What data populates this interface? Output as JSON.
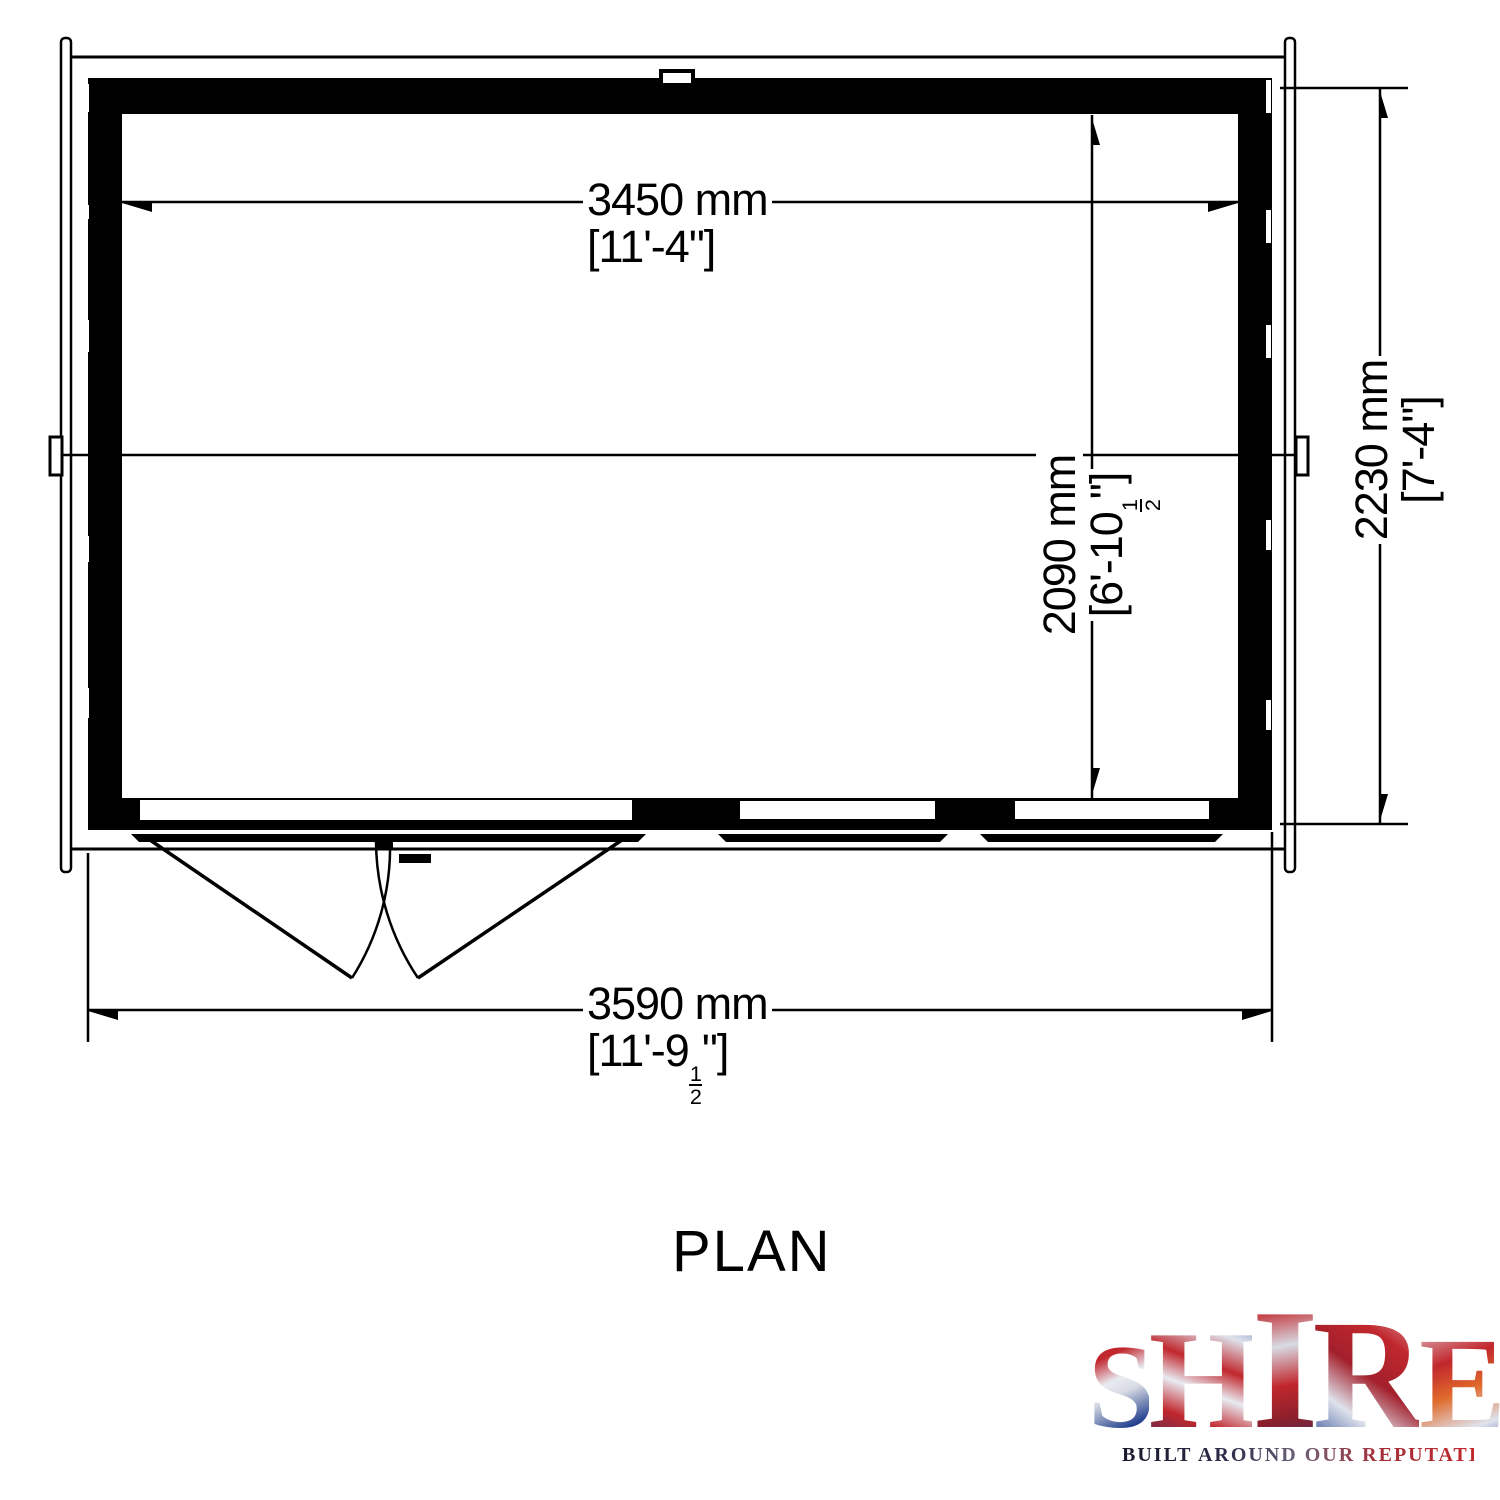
{
  "plan": {
    "title": "PLAN",
    "dimensions": {
      "inner_width": {
        "metric": "3450 mm",
        "imperial": "[11'-4\"]"
      },
      "outer_width": {
        "metric": "3590 mm",
        "imperial_pre": "[11'-9",
        "frac_num": "1",
        "frac_den": "2",
        "imperial_post": "\"]"
      },
      "inner_depth": {
        "metric": "2090 mm",
        "imperial_pre": "[6'-10",
        "frac_num": "1",
        "frac_den": "2",
        "imperial_post": "\"]"
      },
      "outer_depth": {
        "metric": "2230 mm",
        "imperial": "[7'-4\"]"
      }
    }
  },
  "logo": {
    "letters": {
      "s": "S",
      "h": "H",
      "i": "I",
      "r": "R",
      "e": "E"
    },
    "tagline": "BUILT AROUND OUR REPUTATION",
    "colors": {
      "red": "#c1272d",
      "navy": "#24418f",
      "silver": "#e9ebf2"
    }
  },
  "drawing": {
    "line_color": "#000000",
    "background": "#ffffff"
  }
}
